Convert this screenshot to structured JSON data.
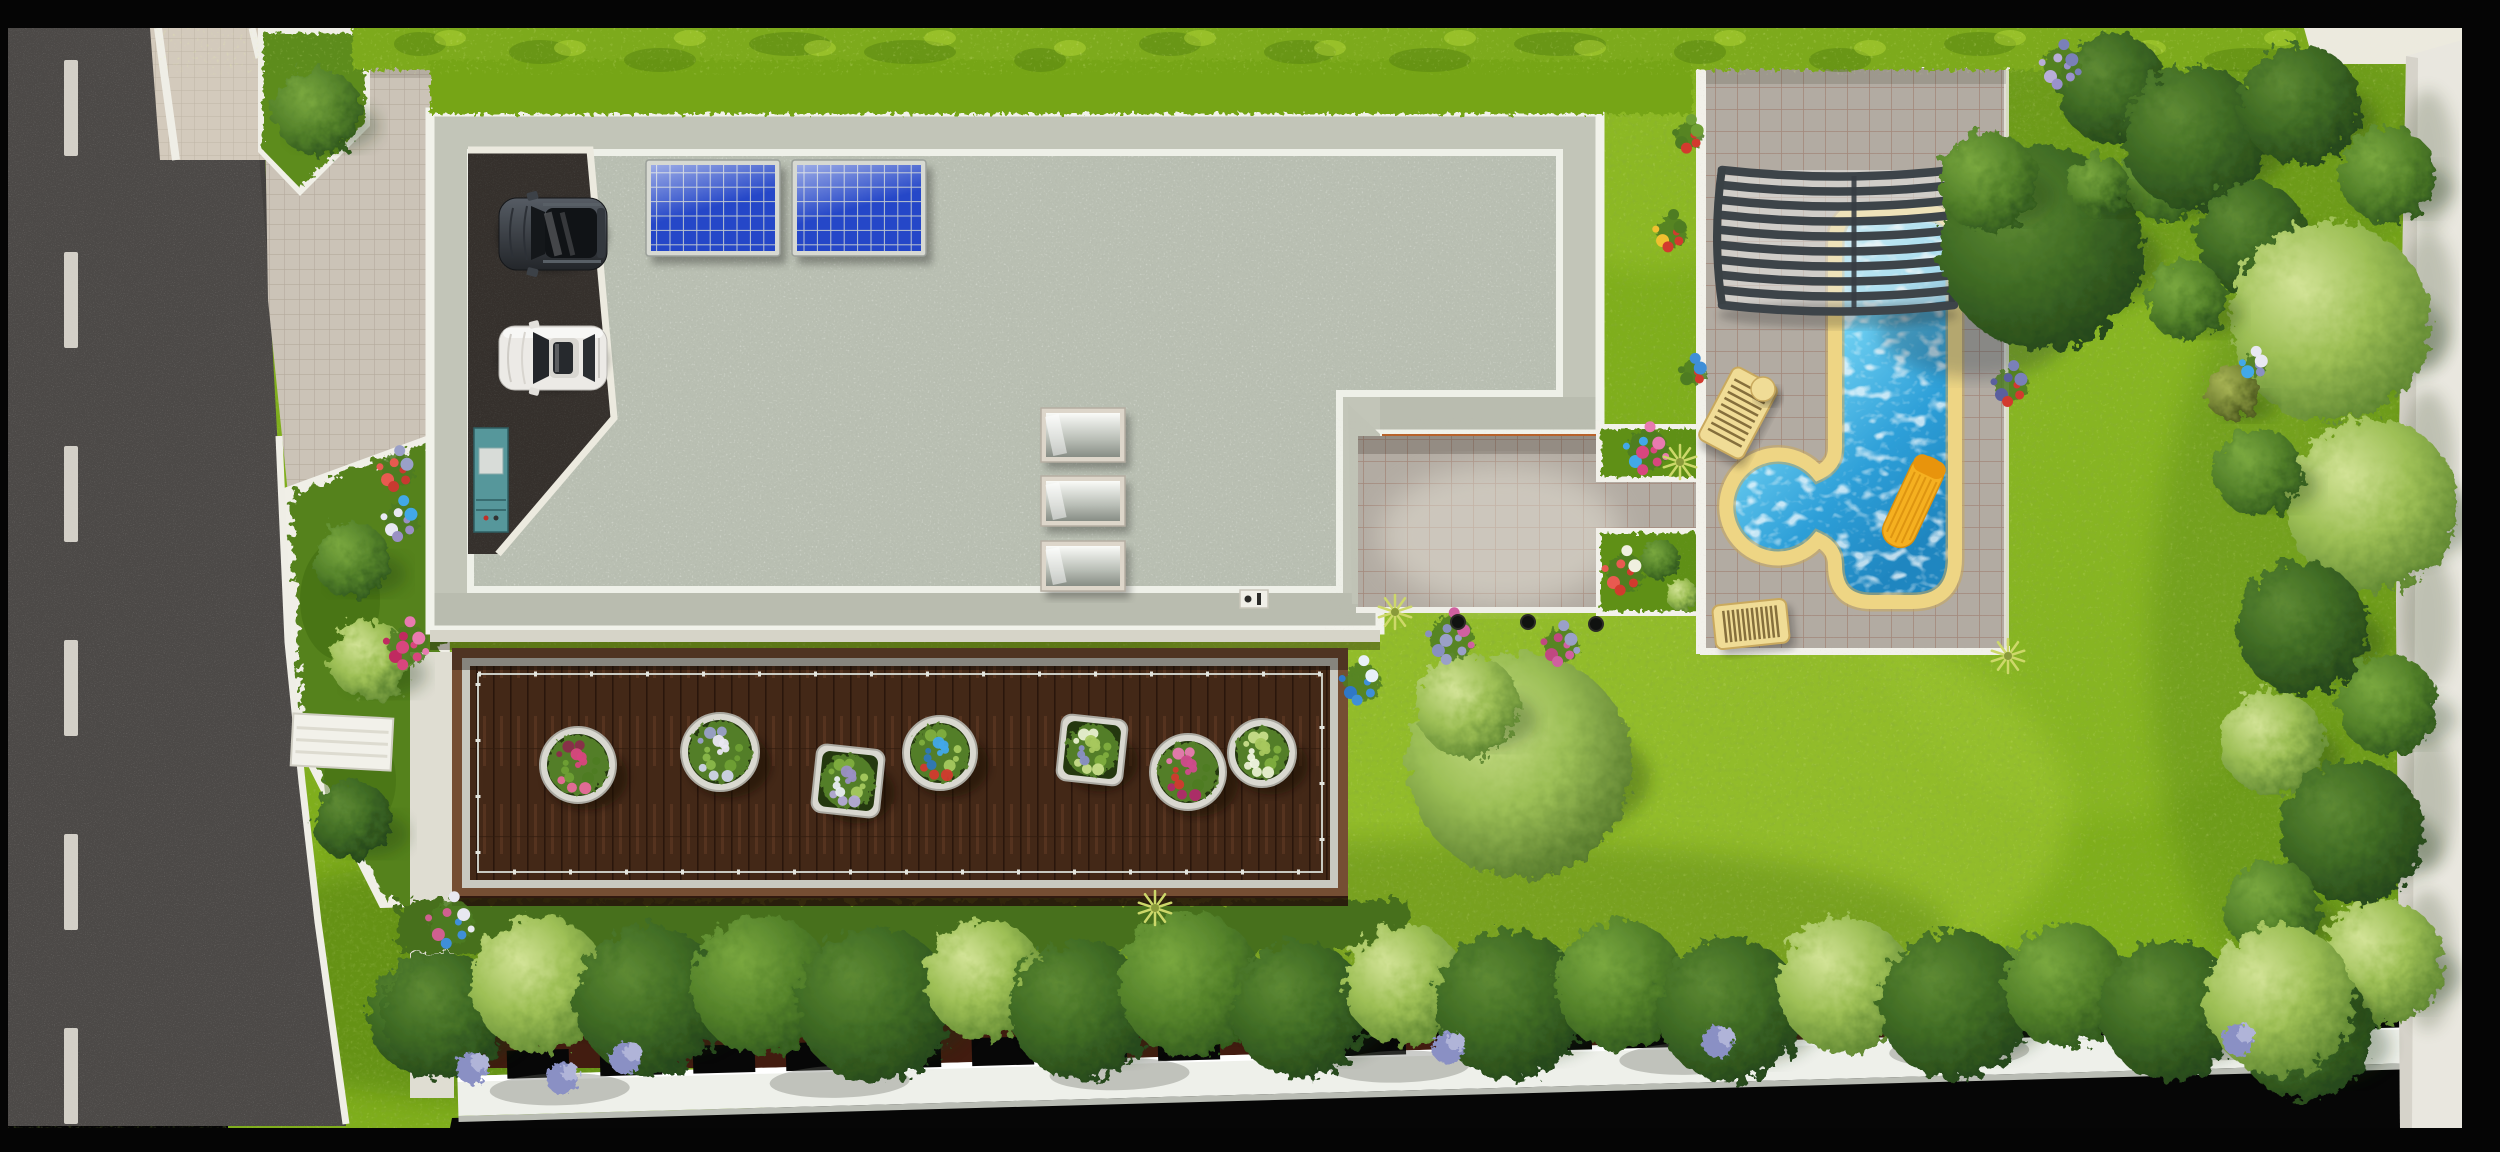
{
  "scene": {
    "kind": "aerial-site-plan-rendering",
    "width": 2500,
    "height": 1152,
    "colors": {
      "asphalt": "#4c4947",
      "lane_dash": "#dedbd2",
      "lawn": "#7fae1c",
      "hedge": "#8fc31f",
      "gravel_roof": "#b9bfb2",
      "roof_band": "#c2c5b8",
      "roof_edge_white": "#f1f2ea",
      "fascia_orange": "#b8622a",
      "deck_wood": "#432817",
      "deck_border": "#754e33",
      "rail_metal": "#c9cac2",
      "pool_water": "#45b9e8",
      "pool_coping": "#eed584",
      "cover_slats": "#3d4449",
      "paver": "#b2aba2",
      "drive_tile": "#cbc3b7",
      "wall_white": "#efeee6",
      "fence_white": "#eef0ea",
      "soil": "#421c10",
      "float_yellow": "#f5b020",
      "lounger_yellow": "#f0dc96",
      "solar_blue": "#2547c8",
      "suv_body": "#41464d",
      "sedan_body": "#eceae6",
      "cabinet_teal": "#56979b"
    }
  },
  "road": {
    "dash_x": 64,
    "dash_w": 14,
    "dash_h": 96,
    "dash_ys": [
      60,
      252,
      446,
      640,
      834,
      1028
    ]
  },
  "hedge": {
    "blotch_xs": [
      420,
      540,
      660,
      790,
      910,
      1040,
      1170,
      1300,
      1430,
      1560,
      1700,
      1840,
      1980,
      2120,
      2250
    ]
  },
  "house": {
    "solar_panels": [
      {
        "x": 646,
        "y": 160,
        "w": 134,
        "h": 96
      },
      {
        "x": 792,
        "y": 160,
        "w": 134,
        "h": 96
      }
    ],
    "skylights": [
      {
        "x": 1041,
        "y": 408,
        "w": 84,
        "h": 54
      },
      {
        "x": 1041,
        "y": 476,
        "w": 84,
        "h": 50
      },
      {
        "x": 1041,
        "y": 541,
        "w": 84,
        "h": 50
      }
    ],
    "cars": [
      {
        "kind": "dark-suv",
        "color": "#41464d"
      },
      {
        "kind": "white-sedan",
        "color": "#eceae6"
      }
    ]
  },
  "deck": {
    "planters": [
      {
        "x": 578,
        "y": 765,
        "r": 32,
        "shape": "circle",
        "palette": [
          "#d8467e",
          "#e86a9a",
          "#8a2d4a",
          "#4e7c22",
          "#6fa034"
        ]
      },
      {
        "x": 720,
        "y": 752,
        "r": 33,
        "shape": "circle",
        "palette": [
          "#e9e7f2",
          "#cfd4e8",
          "#9aa0c8",
          "#6fa034",
          "#8ab84a"
        ]
      },
      {
        "x": 848,
        "y": 781,
        "r": 29,
        "shape": "square",
        "palette": [
          "#9a90c4",
          "#b4aad6",
          "#7fae3e",
          "#a5c95e",
          "#e8eef0"
        ]
      },
      {
        "x": 940,
        "y": 753,
        "r": 31,
        "shape": "circle",
        "palette": [
          "#42a8e8",
          "#d23a2e",
          "#7fae3e",
          "#a5c95e",
          "#2f78b8"
        ]
      },
      {
        "x": 1092,
        "y": 750,
        "r": 28,
        "shape": "square",
        "palette": [
          "#a8c85e",
          "#c8de8a",
          "#e9f0d0",
          "#7fae3e",
          "#8a90c4"
        ]
      },
      {
        "x": 1188,
        "y": 772,
        "r": 32,
        "shape": "circle",
        "palette": [
          "#d04a8c",
          "#b02a6a",
          "#e87ab0",
          "#4e7c22",
          "#d23a2e"
        ]
      },
      {
        "x": 1262,
        "y": 753,
        "r": 28,
        "shape": "circle",
        "palette": [
          "#a8c85e",
          "#e9f0d0",
          "#c8de8a",
          "#7fae3e",
          "#f0f4e0"
        ]
      }
    ]
  },
  "pool": {
    "cover_slat_count": 10,
    "cover_top_y": 170,
    "cover_pitch": 15,
    "loungers": [
      {
        "x": 1713,
        "y": 372,
        "w": 50,
        "h": 82,
        "angle": 28,
        "slats": 10,
        "axis": "h"
      },
      {
        "x": 1714,
        "y": 602,
        "w": 74,
        "h": 44,
        "angle": -6,
        "slats": 13,
        "axis": "v"
      }
    ],
    "table": {
      "x": 1763,
      "y": 389,
      "r": 12
    }
  },
  "garden": {
    "trees_bottom": [
      {
        "x": 445,
        "y": 1015,
        "r": 62,
        "tone": "dark"
      },
      {
        "x": 540,
        "y": 985,
        "r": 68,
        "tone": "light"
      },
      {
        "x": 650,
        "y": 1000,
        "r": 75,
        "tone": "dark"
      },
      {
        "x": 762,
        "y": 985,
        "r": 70,
        "tone": "mid"
      },
      {
        "x": 875,
        "y": 1005,
        "r": 78,
        "tone": "dark"
      },
      {
        "x": 985,
        "y": 980,
        "r": 60,
        "tone": "light"
      },
      {
        "x": 1080,
        "y": 1010,
        "r": 70,
        "tone": "dark"
      },
      {
        "x": 1190,
        "y": 985,
        "r": 72,
        "tone": "mid"
      },
      {
        "x": 1300,
        "y": 1010,
        "r": 68,
        "tone": "dark"
      },
      {
        "x": 1405,
        "y": 985,
        "r": 60,
        "tone": "light"
      },
      {
        "x": 1510,
        "y": 1005,
        "r": 75,
        "tone": "dark"
      },
      {
        "x": 1620,
        "y": 985,
        "r": 65,
        "tone": "mid"
      },
      {
        "x": 1730,
        "y": 1010,
        "r": 72,
        "tone": "dark"
      },
      {
        "x": 1845,
        "y": 985,
        "r": 68,
        "tone": "light"
      },
      {
        "x": 1955,
        "y": 1005,
        "r": 75,
        "tone": "dark"
      },
      {
        "x": 2065,
        "y": 985,
        "r": 62,
        "tone": "mid"
      },
      {
        "x": 2170,
        "y": 1010,
        "r": 70,
        "tone": "dark"
      },
      {
        "x": 2280,
        "y": 1000,
        "r": 75,
        "tone": "light"
      }
    ],
    "trees_right": [
      {
        "x": 2195,
        "y": 138,
        "r": 72,
        "tone": "dark"
      },
      {
        "x": 2300,
        "y": 105,
        "r": 60,
        "tone": "dark"
      },
      {
        "x": 2388,
        "y": 175,
        "r": 48,
        "tone": "mid"
      },
      {
        "x": 2252,
        "y": 238,
        "r": 56,
        "tone": "dark"
      },
      {
        "x": 2330,
        "y": 322,
        "r": 100,
        "tone": "light"
      },
      {
        "x": 2186,
        "y": 300,
        "r": 40,
        "tone": "mid"
      },
      {
        "x": 2232,
        "y": 392,
        "r": 27,
        "tone": "olive"
      },
      {
        "x": 2372,
        "y": 505,
        "r": 86,
        "tone": "light"
      },
      {
        "x": 2258,
        "y": 472,
        "r": 44,
        "tone": "mid"
      },
      {
        "x": 2302,
        "y": 628,
        "r": 66,
        "tone": "dark"
      },
      {
        "x": 2388,
        "y": 705,
        "r": 50,
        "tone": "mid"
      },
      {
        "x": 2272,
        "y": 742,
        "r": 52,
        "tone": "light"
      },
      {
        "x": 2352,
        "y": 832,
        "r": 72,
        "tone": "dark"
      },
      {
        "x": 2272,
        "y": 908,
        "r": 48,
        "tone": "mid"
      },
      {
        "x": 2382,
        "y": 962,
        "r": 62,
        "tone": "light"
      },
      {
        "x": 2305,
        "y": 1032,
        "r": 68,
        "tone": "dark"
      }
    ],
    "trees_corner": [
      {
        "x": 2112,
        "y": 88,
        "r": 55,
        "tone": "dark"
      },
      {
        "x": 2165,
        "y": 178,
        "r": 44,
        "tone": "mid"
      },
      {
        "x": 2098,
        "y": 185,
        "r": 30,
        "tone": "mid"
      }
    ],
    "left_bushes": [
      {
        "x": 318,
        "y": 112,
        "r": 44,
        "tone": "mid"
      },
      {
        "x": 352,
        "y": 560,
        "r": 38,
        "tone": "mid"
      },
      {
        "x": 370,
        "y": 660,
        "r": 40,
        "tone": "light"
      },
      {
        "x": 352,
        "y": 820,
        "r": 40,
        "tone": "dark"
      },
      {
        "x": 430,
        "y": 1015,
        "r": 62,
        "tone": "dark"
      }
    ],
    "center_bushes": [
      {
        "x": 1520,
        "y": 765,
        "r": 112,
        "tone": "lime"
      },
      {
        "x": 1468,
        "y": 706,
        "r": 52,
        "tone": "light"
      }
    ],
    "pool_trees": [
      {
        "x": 2042,
        "y": 248,
        "r": 102,
        "tone": "dark"
      },
      {
        "x": 1988,
        "y": 182,
        "r": 50,
        "tone": "mid"
      }
    ],
    "flower_clusters": [
      {
        "x": 452,
        "y": 922,
        "colors": [
          "#3f8fd8",
          "#d06090",
          "#e8e8f0"
        ],
        "n": 9,
        "spread": 26
      },
      {
        "x": 1362,
        "y": 682,
        "colors": [
          "#3f8fd8",
          "#2f78c8",
          "#e8f0f8"
        ],
        "n": 7,
        "spread": 22
      },
      {
        "x": 398,
        "y": 470,
        "colors": [
          "#c83a30",
          "#e85a50",
          "#9aa0c8"
        ],
        "n": 8,
        "spread": 20
      },
      {
        "x": 402,
        "y": 520,
        "colors": [
          "#9a90c4",
          "#e8e8f2",
          "#42a8e8"
        ],
        "n": 8,
        "spread": 20
      },
      {
        "x": 408,
        "y": 645,
        "colors": [
          "#d8467e",
          "#c02a60",
          "#e87ab0"
        ],
        "n": 10,
        "spread": 24
      },
      {
        "x": 1648,
        "y": 450,
        "colors": [
          "#d8467e",
          "#42a8e8",
          "#e87ab0"
        ],
        "n": 10,
        "spread": 24
      },
      {
        "x": 1625,
        "y": 572,
        "colors": [
          "#d23a2e",
          "#e85a50",
          "#f0f0e0"
        ],
        "n": 8,
        "spread": 22
      },
      {
        "x": 1672,
        "y": 232,
        "colors": [
          "#d23a2e",
          "#f0c030",
          "#4e7c22"
        ],
        "n": 7,
        "spread": 18
      },
      {
        "x": 1690,
        "y": 135,
        "colors": [
          "#d23a2e",
          "#4e7c22",
          "#6fa034"
        ],
        "n": 7,
        "spread": 16
      },
      {
        "x": 1694,
        "y": 372,
        "colors": [
          "#d23a2e",
          "#4e7c22",
          "#3f8fd8"
        ],
        "n": 6,
        "spread": 14
      },
      {
        "x": 2012,
        "y": 385,
        "colors": [
          "#d23a2e",
          "#5a5f9e",
          "#7a80b8"
        ],
        "n": 8,
        "spread": 20
      },
      {
        "x": 2062,
        "y": 66,
        "colors": [
          "#9a92cc",
          "#b8aed8",
          "#7a80b8"
        ],
        "n": 9,
        "spread": 22
      },
      {
        "x": 1452,
        "y": 638,
        "colors": [
          "#9aa0c8",
          "#8890c0",
          "#d060a0"
        ],
        "n": 10,
        "spread": 26
      },
      {
        "x": 1562,
        "y": 645,
        "colors": [
          "#d060a0",
          "#c04880",
          "#9aa0c8"
        ],
        "n": 9,
        "spread": 20
      },
      {
        "x": 2255,
        "y": 365,
        "colors": [
          "#8a90c4",
          "#42a8e8",
          "#e8e8f2"
        ],
        "n": 6,
        "spread": 14
      }
    ],
    "lavender_bottom": [
      {
        "x": 472,
        "y": 1068
      },
      {
        "x": 562,
        "y": 1078
      },
      {
        "x": 625,
        "y": 1058
      },
      {
        "x": 1448,
        "y": 1048
      },
      {
        "x": 1718,
        "y": 1042
      },
      {
        "x": 2238,
        "y": 1040
      }
    ],
    "spot_dots": [
      {
        "x": 1458,
        "y": 622
      },
      {
        "x": 1528,
        "y": 622
      },
      {
        "x": 1596,
        "y": 624
      }
    ],
    "tufts": [
      {
        "x": 1155,
        "y": 908
      },
      {
        "x": 1395,
        "y": 612
      },
      {
        "x": 2008,
        "y": 656
      },
      {
        "x": 1680,
        "y": 462
      }
    ],
    "grass_patches": [
      {
        "x": 1550,
        "y": 810,
        "rx": 520,
        "ry": 240,
        "c": "#aacf3a",
        "o": 0.45
      },
      {
        "x": 950,
        "y": 960,
        "rx": 420,
        "ry": 130,
        "c": "#a2c832",
        "o": 0.35
      },
      {
        "x": 2090,
        "y": 520,
        "rx": 240,
        "ry": 300,
        "c": "#9cc632",
        "o": 0.3
      },
      {
        "x": 1650,
        "y": 180,
        "rx": 120,
        "ry": 90,
        "c": "#a6cc34",
        "o": 0.35
      },
      {
        "x": 2200,
        "y": 150,
        "rx": 260,
        "ry": 140,
        "c": "#4e7a14",
        "o": 0.35
      },
      {
        "x": 480,
        "y": 980,
        "rx": 300,
        "ry": 120,
        "c": "#3f6b10",
        "o": 0.4
      },
      {
        "x": 1450,
        "y": 930,
        "rx": 500,
        "ry": 90,
        "c": "#48720f",
        "o": 0.35
      },
      {
        "x": 2330,
        "y": 640,
        "rx": 180,
        "ry": 400,
        "c": "#487512",
        "o": 0.3
      }
    ]
  },
  "boundary": {
    "fence_notches": {
      "count": 21,
      "start_x": 508,
      "step": 93,
      "w": 62,
      "h": 28
    },
    "fence_shadow_xs": [
      560,
      840,
      1120,
      1400,
      1690,
      1960,
      2230
    ],
    "wall_shadow_ys": [
      160,
      300,
      460,
      620,
      800,
      960
    ]
  }
}
